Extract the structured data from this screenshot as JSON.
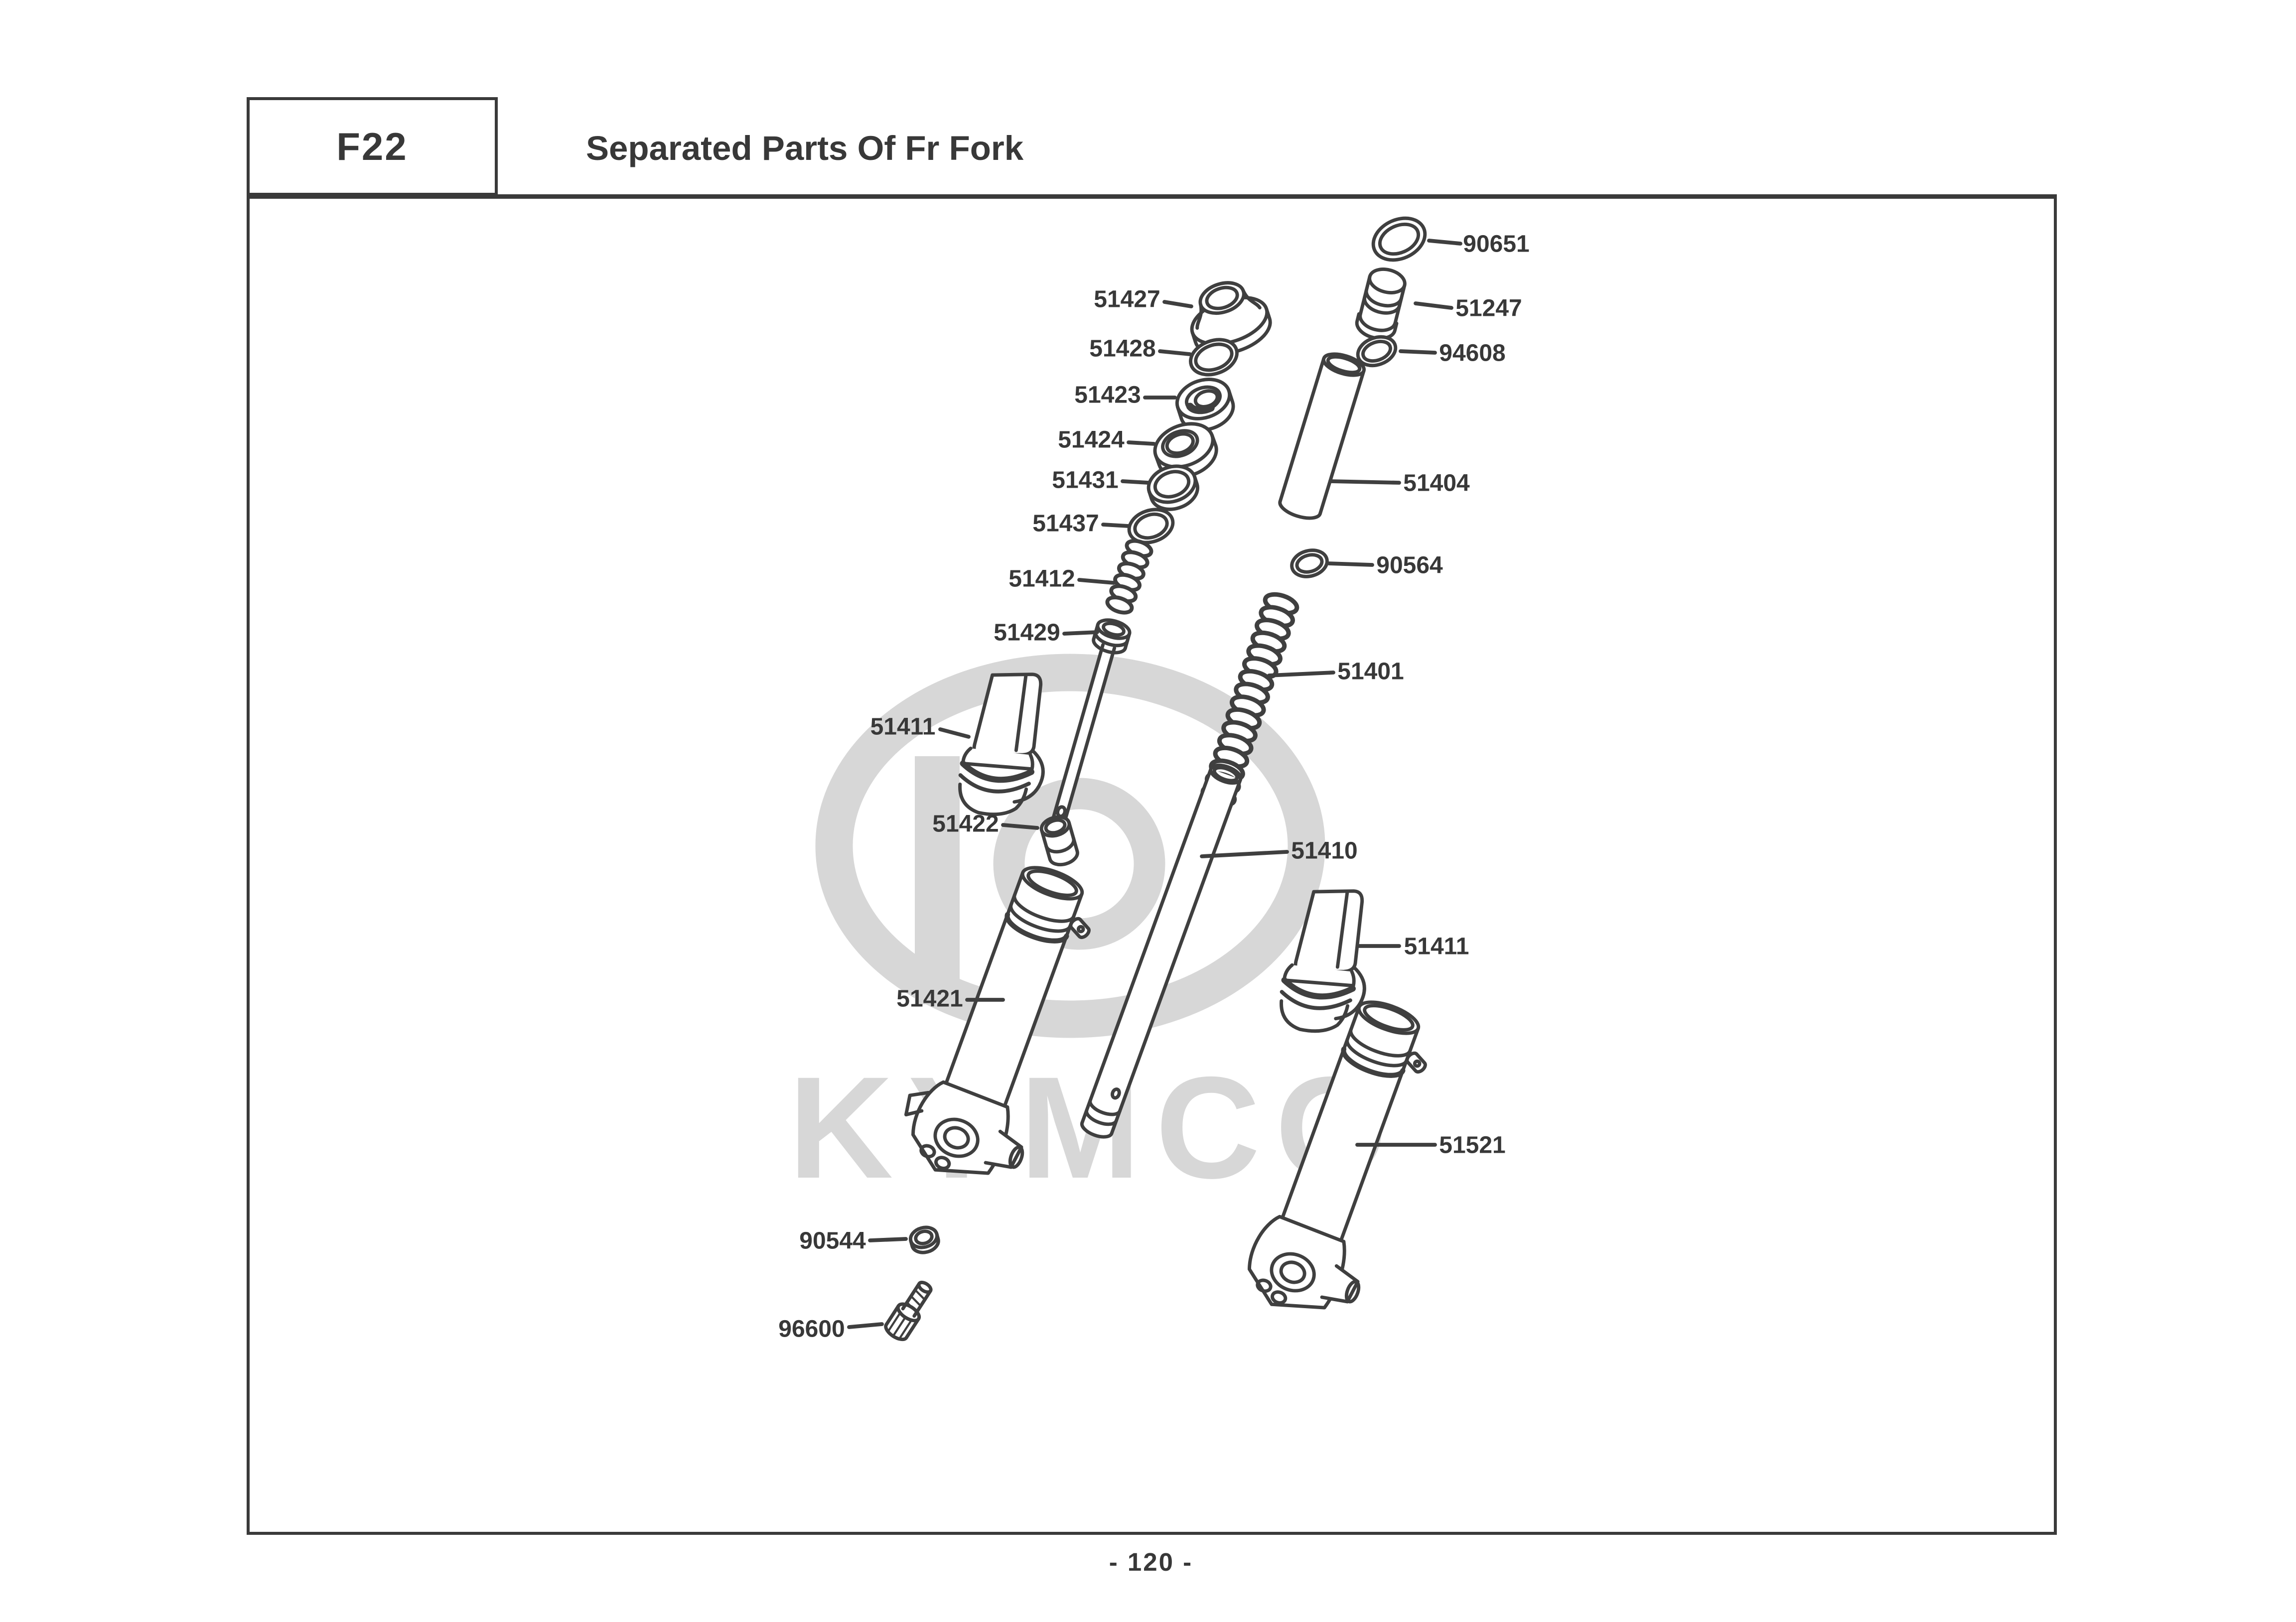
{
  "header": {
    "code": "F22",
    "title": "Separated Parts Of Fr Fork"
  },
  "watermark": {
    "brand": "KYMCO"
  },
  "footer": {
    "page_number": "- 120 -"
  },
  "parts": [
    {
      "label": "90651"
    },
    {
      "label": "51427"
    },
    {
      "label": "51247"
    },
    {
      "label": "51428"
    },
    {
      "label": "94608"
    },
    {
      "label": "51423"
    },
    {
      "label": "51424"
    },
    {
      "label": "51431"
    },
    {
      "label": "51404"
    },
    {
      "label": "51437"
    },
    {
      "label": "90564"
    },
    {
      "label": "51412"
    },
    {
      "label": "51429"
    },
    {
      "label": "51401"
    },
    {
      "label": "51411"
    },
    {
      "label": "51422"
    },
    {
      "label": "51410"
    },
    {
      "label": "51411"
    },
    {
      "label": "51421"
    },
    {
      "label": "51521"
    },
    {
      "label": "90544"
    },
    {
      "label": "96600"
    }
  ]
}
